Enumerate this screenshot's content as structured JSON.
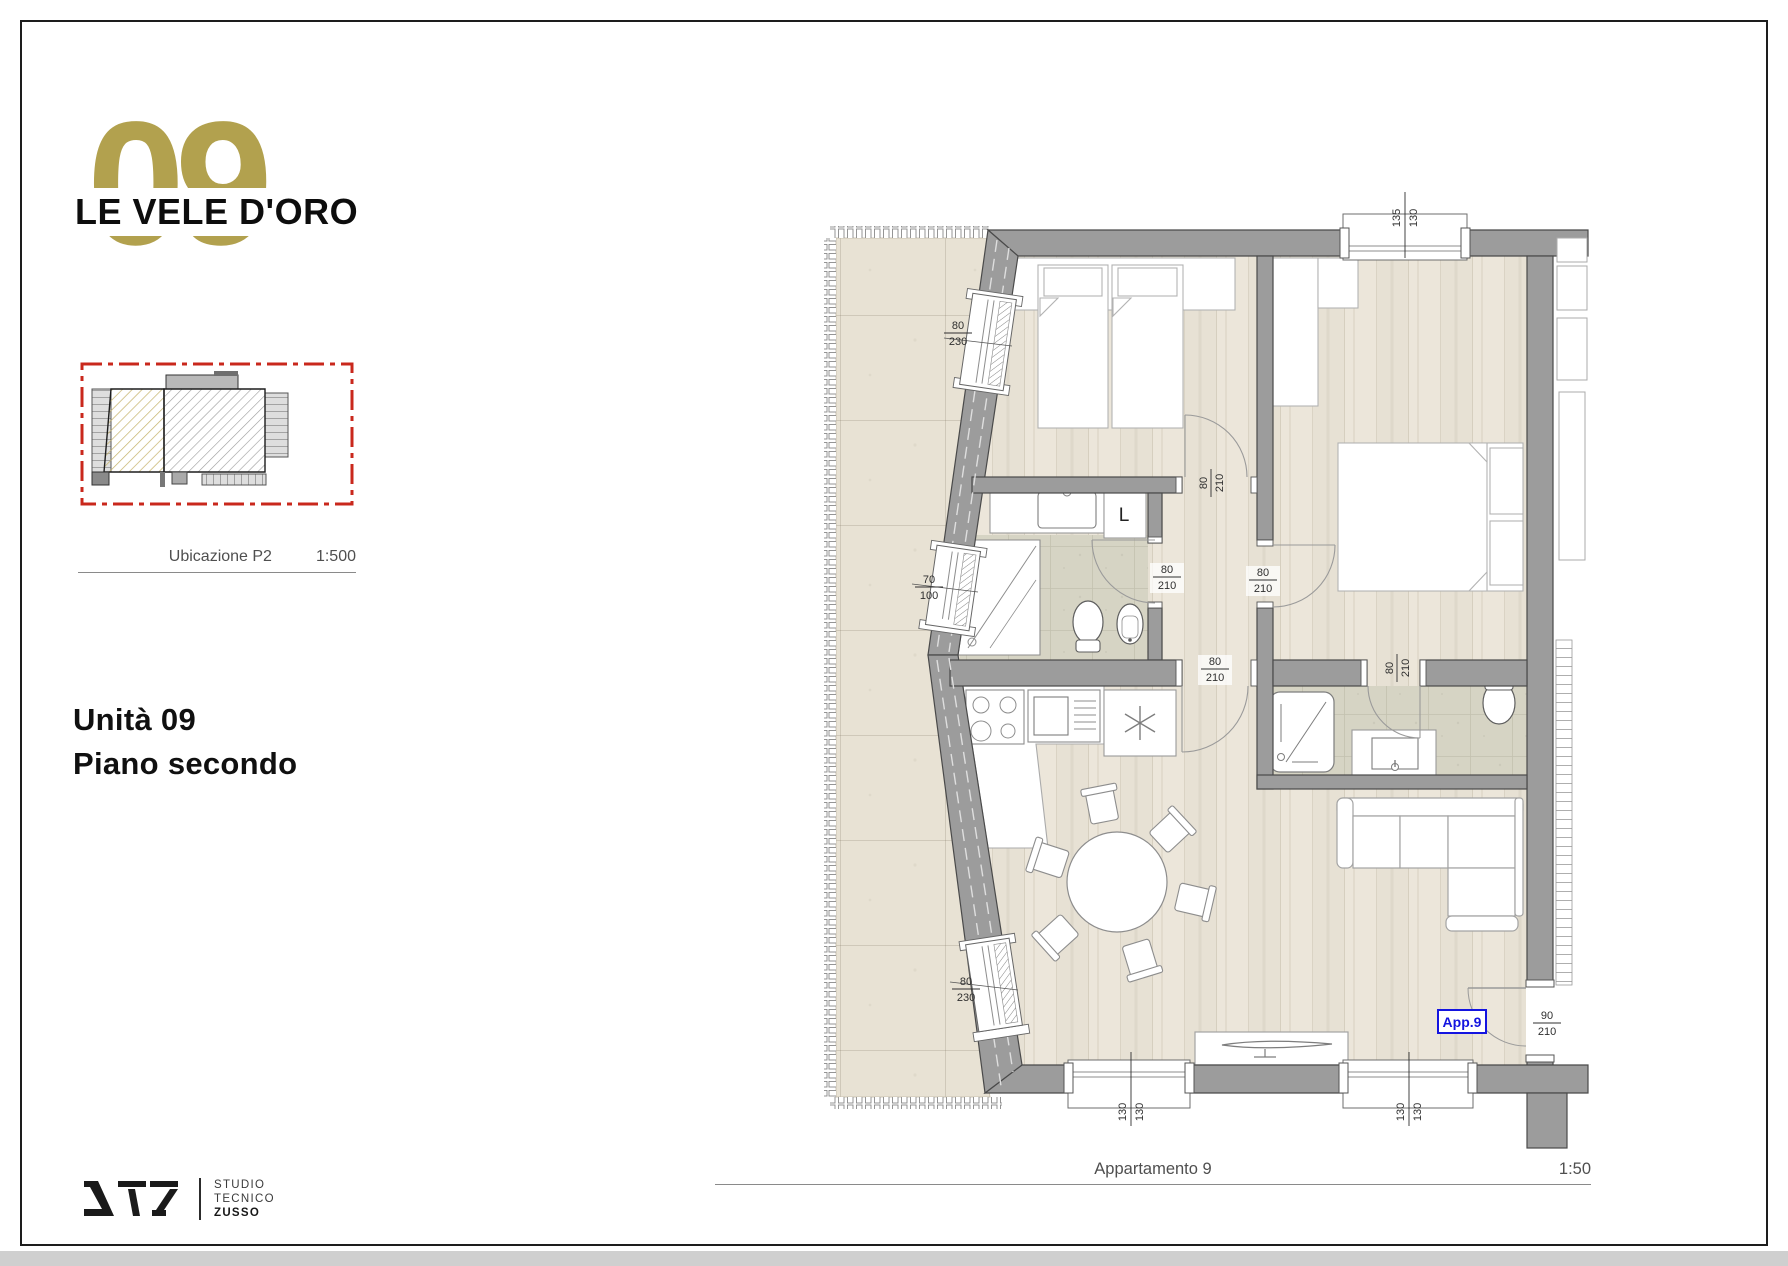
{
  "branding": {
    "unit_number": "09",
    "name": "LE VELE D'ORO",
    "gold": "#b2a14e"
  },
  "location_map": {
    "caption": "Ubicazione P2",
    "scale": "1:500",
    "border_color": "#c9281c"
  },
  "unit_title": {
    "line1": "Unità 09",
    "line2": "Piano secondo"
  },
  "plan_caption": {
    "label": "Appartamento 9",
    "scale": "1:50"
  },
  "plan": {
    "apartment_tag": "App.9",
    "washer_label": "L",
    "colors": {
      "wall": "#9c9c9c",
      "wall_outline": "#4a4a4a",
      "wood": "#ebe5d9",
      "tile": "#d6d4c4",
      "terrace": "#e8e2d4",
      "tag_blue": "#1414e0"
    },
    "dims": {
      "win_left_top": {
        "num": "80",
        "den": "230"
      },
      "win_left_mid": {
        "num": "70",
        "den": "100"
      },
      "win_left_bot": {
        "num": "80",
        "den": "230"
      },
      "win_top": {
        "num": "135",
        "den": "130"
      },
      "door_bed1": {
        "num": "80",
        "den": "210"
      },
      "door_bath1": {
        "num": "80",
        "den": "210"
      },
      "door_bed2": {
        "num": "80",
        "den": "210"
      },
      "door_living": {
        "num": "80",
        "den": "210"
      },
      "door_bath2": {
        "num": "80",
        "den": "210"
      },
      "door_entry": {
        "num": "90",
        "den": "210"
      },
      "win_bot_left": {
        "num": "130",
        "den": "130"
      },
      "win_bot_right": {
        "num": "130",
        "den": "130"
      }
    }
  },
  "studio": {
    "lines": [
      "STUDIO",
      "TECNICO",
      "ZUSSO"
    ]
  }
}
